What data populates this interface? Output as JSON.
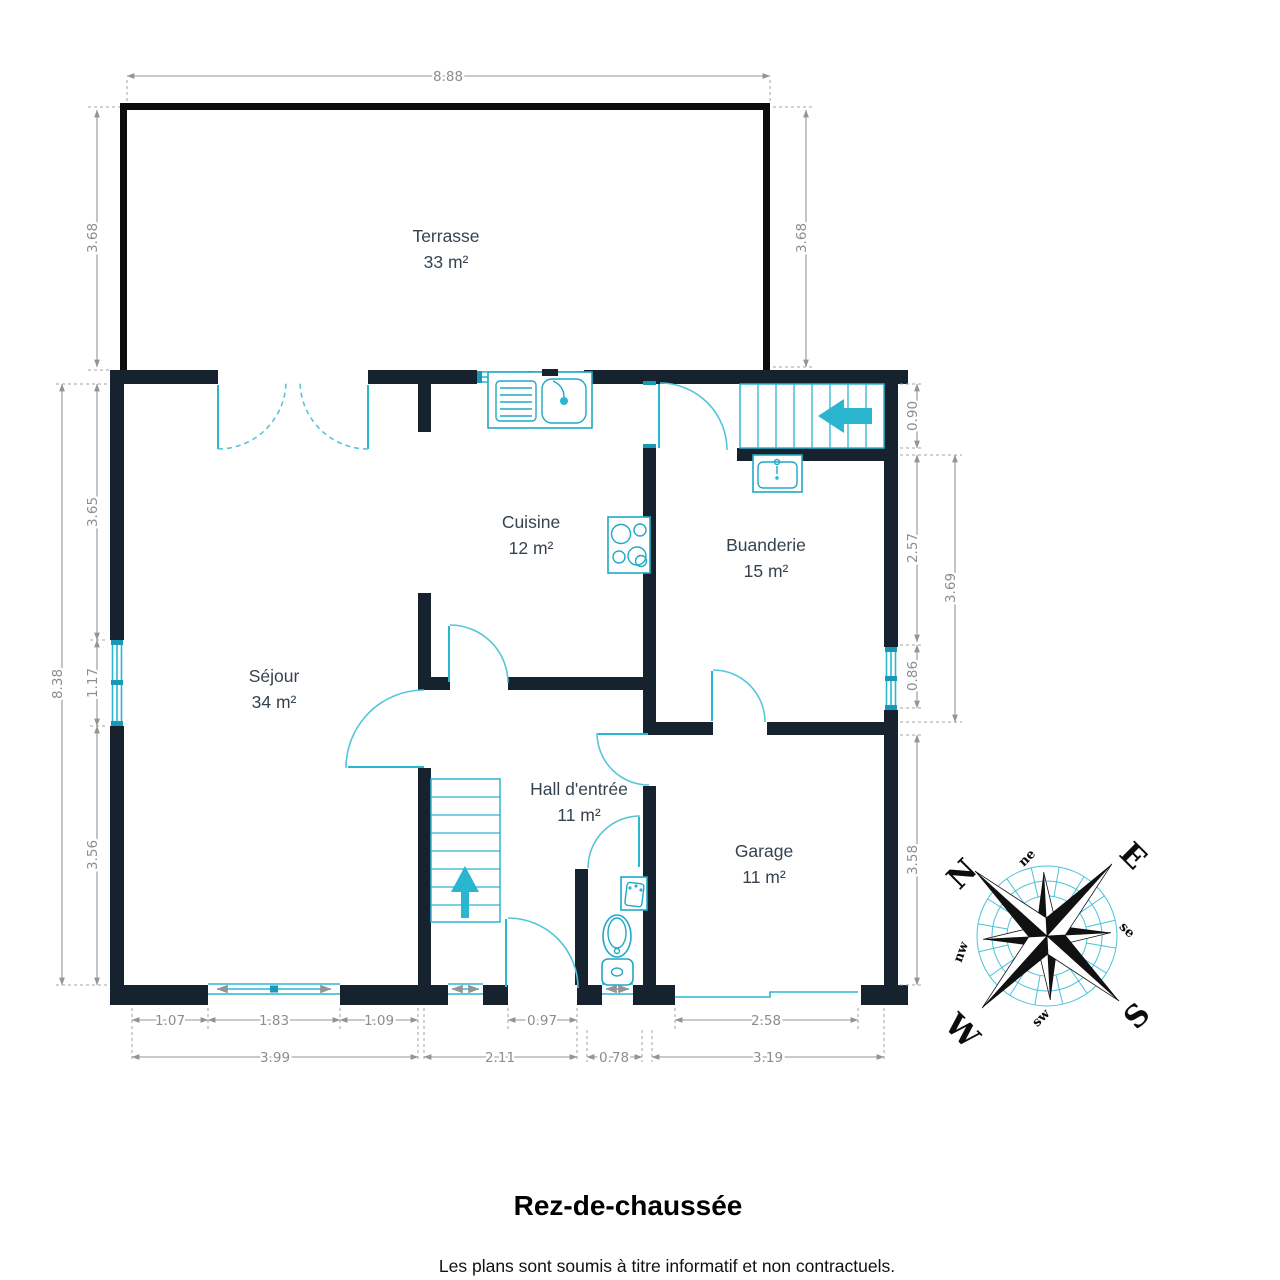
{
  "page": {
    "title": "Rez-de-chaussée",
    "disclaimer": "Les plans sont soumis à titre informatif et non contractuels."
  },
  "rooms": {
    "terrasse": {
      "name": "Terrasse",
      "area": "33 m²"
    },
    "cuisine": {
      "name": "Cuisine",
      "area": "12 m²"
    },
    "buanderie": {
      "name": "Buanderie",
      "area": "15 m²"
    },
    "sejour": {
      "name": "Séjour",
      "area": "34 m²"
    },
    "hall": {
      "name": "Hall d'entrée",
      "area": "11 m²"
    },
    "garage": {
      "name": "Garage",
      "area": "11 m²"
    }
  },
  "dims": {
    "top": "8.88",
    "terrace_left": "3.68",
    "terrace_right": "3.68",
    "left_total": "8.38",
    "left_upper": "3.65",
    "left_window": "1.17",
    "left_lower": "3.56",
    "stairs": "0.90",
    "laundry_upper": "2.57",
    "laundry_window": "0.86",
    "laundry_total": "3.69",
    "garage_side": "3.58",
    "b1": "1.07",
    "b2": "1.83",
    "b3": "1.09",
    "b4": "0.97",
    "b5": "2.58",
    "c1": "3.99",
    "c2": "2.11",
    "c3": "0.78",
    "c4": "3.19"
  },
  "compass": {
    "n": "N",
    "e": "E",
    "s": "S",
    "w": "W",
    "ne": "ne",
    "se": "se",
    "sw": "sw",
    "nw": "nw"
  },
  "colors": {
    "wall": "#16232e",
    "terrace_wall": "#0c0c0c",
    "fixture": "#2ab5d0",
    "door_arc": "#54c6da",
    "dimension": "#8d8d8d",
    "room_label": "#36434f"
  }
}
